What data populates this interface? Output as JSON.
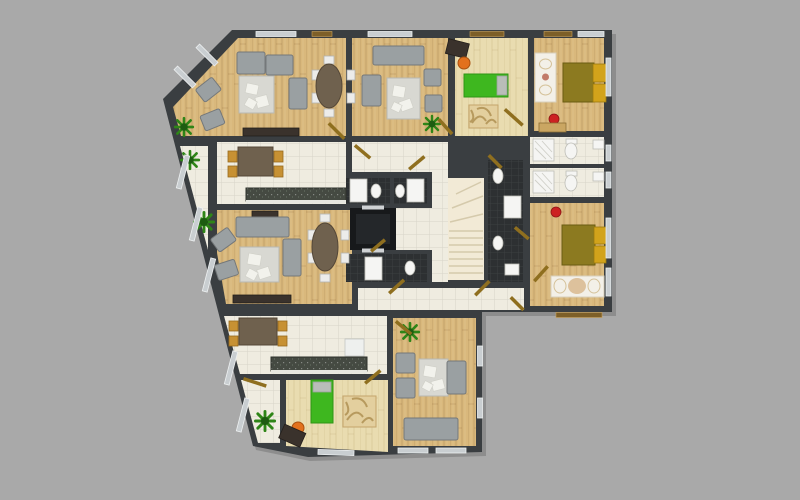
{
  "scene": {
    "description": "Top-down 3D rendered architectural floor plan of one storey of an apartment building, shown on a plain gray background. No text labels are visible.",
    "view": "top-down floor plan",
    "background_label": "gray backdrop"
  },
  "palette": {
    "background": "#a9a9a9",
    "wall": "#3a3e41",
    "wood-floor": "#d9b87c",
    "light-wood-floor": "#e9dcb0",
    "tile-floor": "#efece0",
    "dark-tile-floor": "#2d3032",
    "stair-floor": "#f2ead6",
    "elevator-shaft": "#17191b",
    "counter-dark": "#454a42",
    "sofa-gray": "#9aa0a2",
    "rug-light": "#d8d8d2",
    "rug-tan": "#e3cf9e",
    "rug-white": "#f3f0e8",
    "table-brown": "#6f614e",
    "chair-gold": "#c79133",
    "bed-olive": "#8c7a20",
    "bed-yellow": "#d2a31b",
    "kids-bed-green": "#3eb71f",
    "pillow-gray": "#b9bdb9",
    "chair-orange": "#e2711d",
    "desk-dark": "#3a322c",
    "plant-green": "#2e8517",
    "plant-dark": "#1e5c12",
    "door-gold": "#8f6f1f",
    "fixture-white": "#f5f5f3",
    "window-light": "#c9ced1",
    "window-brown": "#7d5f28",
    "red-accent": "#cc2222"
  },
  "rooms": [
    {
      "id": "living-room-1",
      "label": "Living room (top-left)",
      "floor": "wood",
      "furniture": [
        "corner-sofa",
        "two-rotated-armchairs",
        "light-rug-with-cushions",
        "loveseat",
        "oval-dining-table",
        "six-white-chairs",
        "sideboard",
        "potted-plant"
      ]
    },
    {
      "id": "kitchen-1",
      "label": "Kitchen (left)",
      "floor": "light-tile",
      "furniture": [
        "dining-table",
        "four-gold-chairs",
        "dark-counter"
      ]
    },
    {
      "id": "living-room-2",
      "label": "Living room (middle-left)",
      "floor": "wood",
      "furniture": [
        "tv-stand",
        "sofa",
        "two-rotated-armchairs",
        "light-rug",
        "loveseat",
        "oval-dining-table",
        "six-white-chairs",
        "sideboard",
        "potted-plant"
      ]
    },
    {
      "id": "living-room-3",
      "label": "Living room (top-middle)",
      "floor": "wood",
      "furniture": [
        "sofa",
        "side-sofa",
        "light-rug",
        "two-armchairs",
        "potted-plant"
      ]
    },
    {
      "id": "kids-room-1",
      "label": "Kids room (top)",
      "floor": "light-wood",
      "furniture": [
        "dark-desk",
        "orange-chair",
        "green-single-bed",
        "tan-patterned-rug"
      ]
    },
    {
      "id": "bedroom-1",
      "label": "Bedroom (top-right)",
      "floor": "wood",
      "furniture": [
        "double-bed-olive-yellow",
        "white-runner-rug",
        "red-ball",
        "dresser"
      ]
    },
    {
      "id": "bedroom-2",
      "label": "Bedroom (right-middle)",
      "floor": "wood",
      "furniture": [
        "double-bed-olive-yellow",
        "white-runner-rug",
        "red-ball"
      ]
    },
    {
      "id": "kitchen-2",
      "label": "Kitchen (bottom)",
      "floor": "light-tile",
      "furniture": [
        "dining-table",
        "four-gold-chairs",
        "dark-counter",
        "fridge"
      ]
    },
    {
      "id": "kids-room-2",
      "label": "Kids room (bottom)",
      "floor": "light-wood",
      "furniture": [
        "green-single-bed",
        "tan-patterned-rug",
        "orange-chair",
        "dark-desk"
      ]
    },
    {
      "id": "living-room-4",
      "label": "Living room (bottom-right)",
      "floor": "wood",
      "furniture": [
        "two-armchairs",
        "light-rug",
        "loveseat",
        "sofa",
        "potted-plant"
      ]
    },
    {
      "id": "bathroom-1",
      "label": "Bathroom (core, upper pair)",
      "floor": "dark-tile",
      "furniture": [
        "shower-tray",
        "toilet",
        "shower-tray",
        "toilet"
      ]
    },
    {
      "id": "bathroom-2",
      "label": "Bathroom (core, lower pair)",
      "floor": "dark-tile",
      "furniture": [
        "shower-tray",
        "toilet"
      ]
    },
    {
      "id": "bathroom-3",
      "label": "Bathroom (core, right column)",
      "floor": "dark-tile",
      "furniture": [
        "toilet",
        "shower-tray",
        "toilet",
        "sink"
      ]
    },
    {
      "id": "bathroom-4",
      "label": "Bathroom (right, upper)",
      "floor": "light-tile",
      "furniture": [
        "corner-shower",
        "toilet",
        "sink"
      ]
    },
    {
      "id": "bathroom-5",
      "label": "Bathroom (right, lower)",
      "floor": "light-tile",
      "furniture": [
        "corner-shower",
        "toilet",
        "sink"
      ]
    },
    {
      "id": "corridor-top",
      "label": "Corridor (upper)",
      "floor": "light-tile",
      "furniture": []
    },
    {
      "id": "hallway-main",
      "label": "Hallway (lower)",
      "floor": "light-tile",
      "furniture": []
    },
    {
      "id": "hallway-bottom-left",
      "label": "Entry hall (bottom-left)",
      "floor": "light-tile",
      "furniture": [
        "potted-plant"
      ]
    },
    {
      "id": "staircase",
      "label": "Staircase",
      "floor": "stair",
      "furniture": [
        "steps"
      ]
    },
    {
      "id": "elevator",
      "label": "Elevator shaft",
      "floor": "shaft",
      "furniture": []
    },
    {
      "id": "balcony-left",
      "label": "Balcony strip (left, diagonal)",
      "floor": "light-tile",
      "furniture": [
        "potted-plant",
        "potted-plant"
      ]
    }
  ]
}
